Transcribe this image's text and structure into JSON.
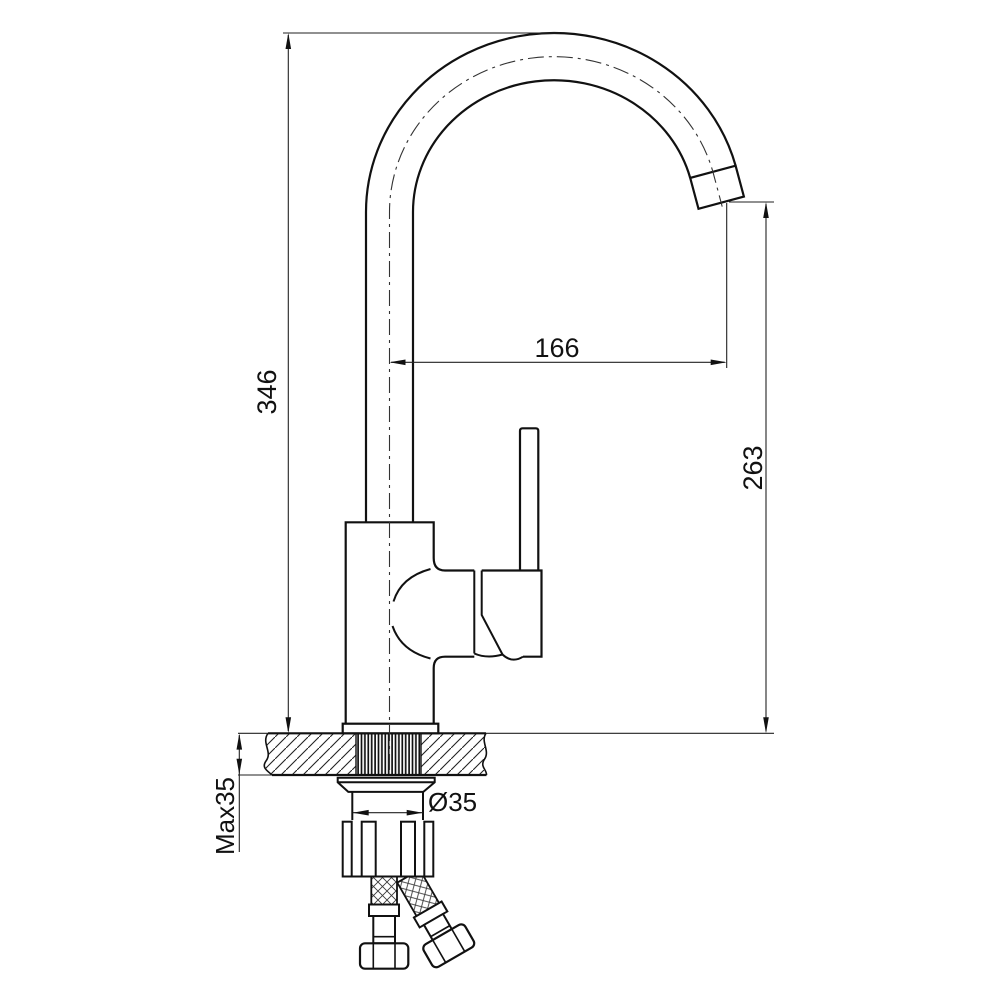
{
  "document": {
    "kind": "technical installation drawing",
    "subject": "single-lever kitchen sink mixer tap, side elevation with mounting detail",
    "background_color": "#ffffff",
    "line_color": "#111111",
    "units_shown": "mm"
  },
  "dimensions": {
    "total_height": {
      "value": "346",
      "orientation": "vertical-left"
    },
    "spout_reach": {
      "value": "166",
      "orientation": "horizontal"
    },
    "spout_outlet_height": {
      "value": "263",
      "orientation": "vertical-right"
    },
    "max_counter_thickness": {
      "value": "Max35",
      "orientation": "vertical-left"
    },
    "mounting_hole_diameter": {
      "value": "Ø35",
      "orientation": "horizontal"
    }
  }
}
